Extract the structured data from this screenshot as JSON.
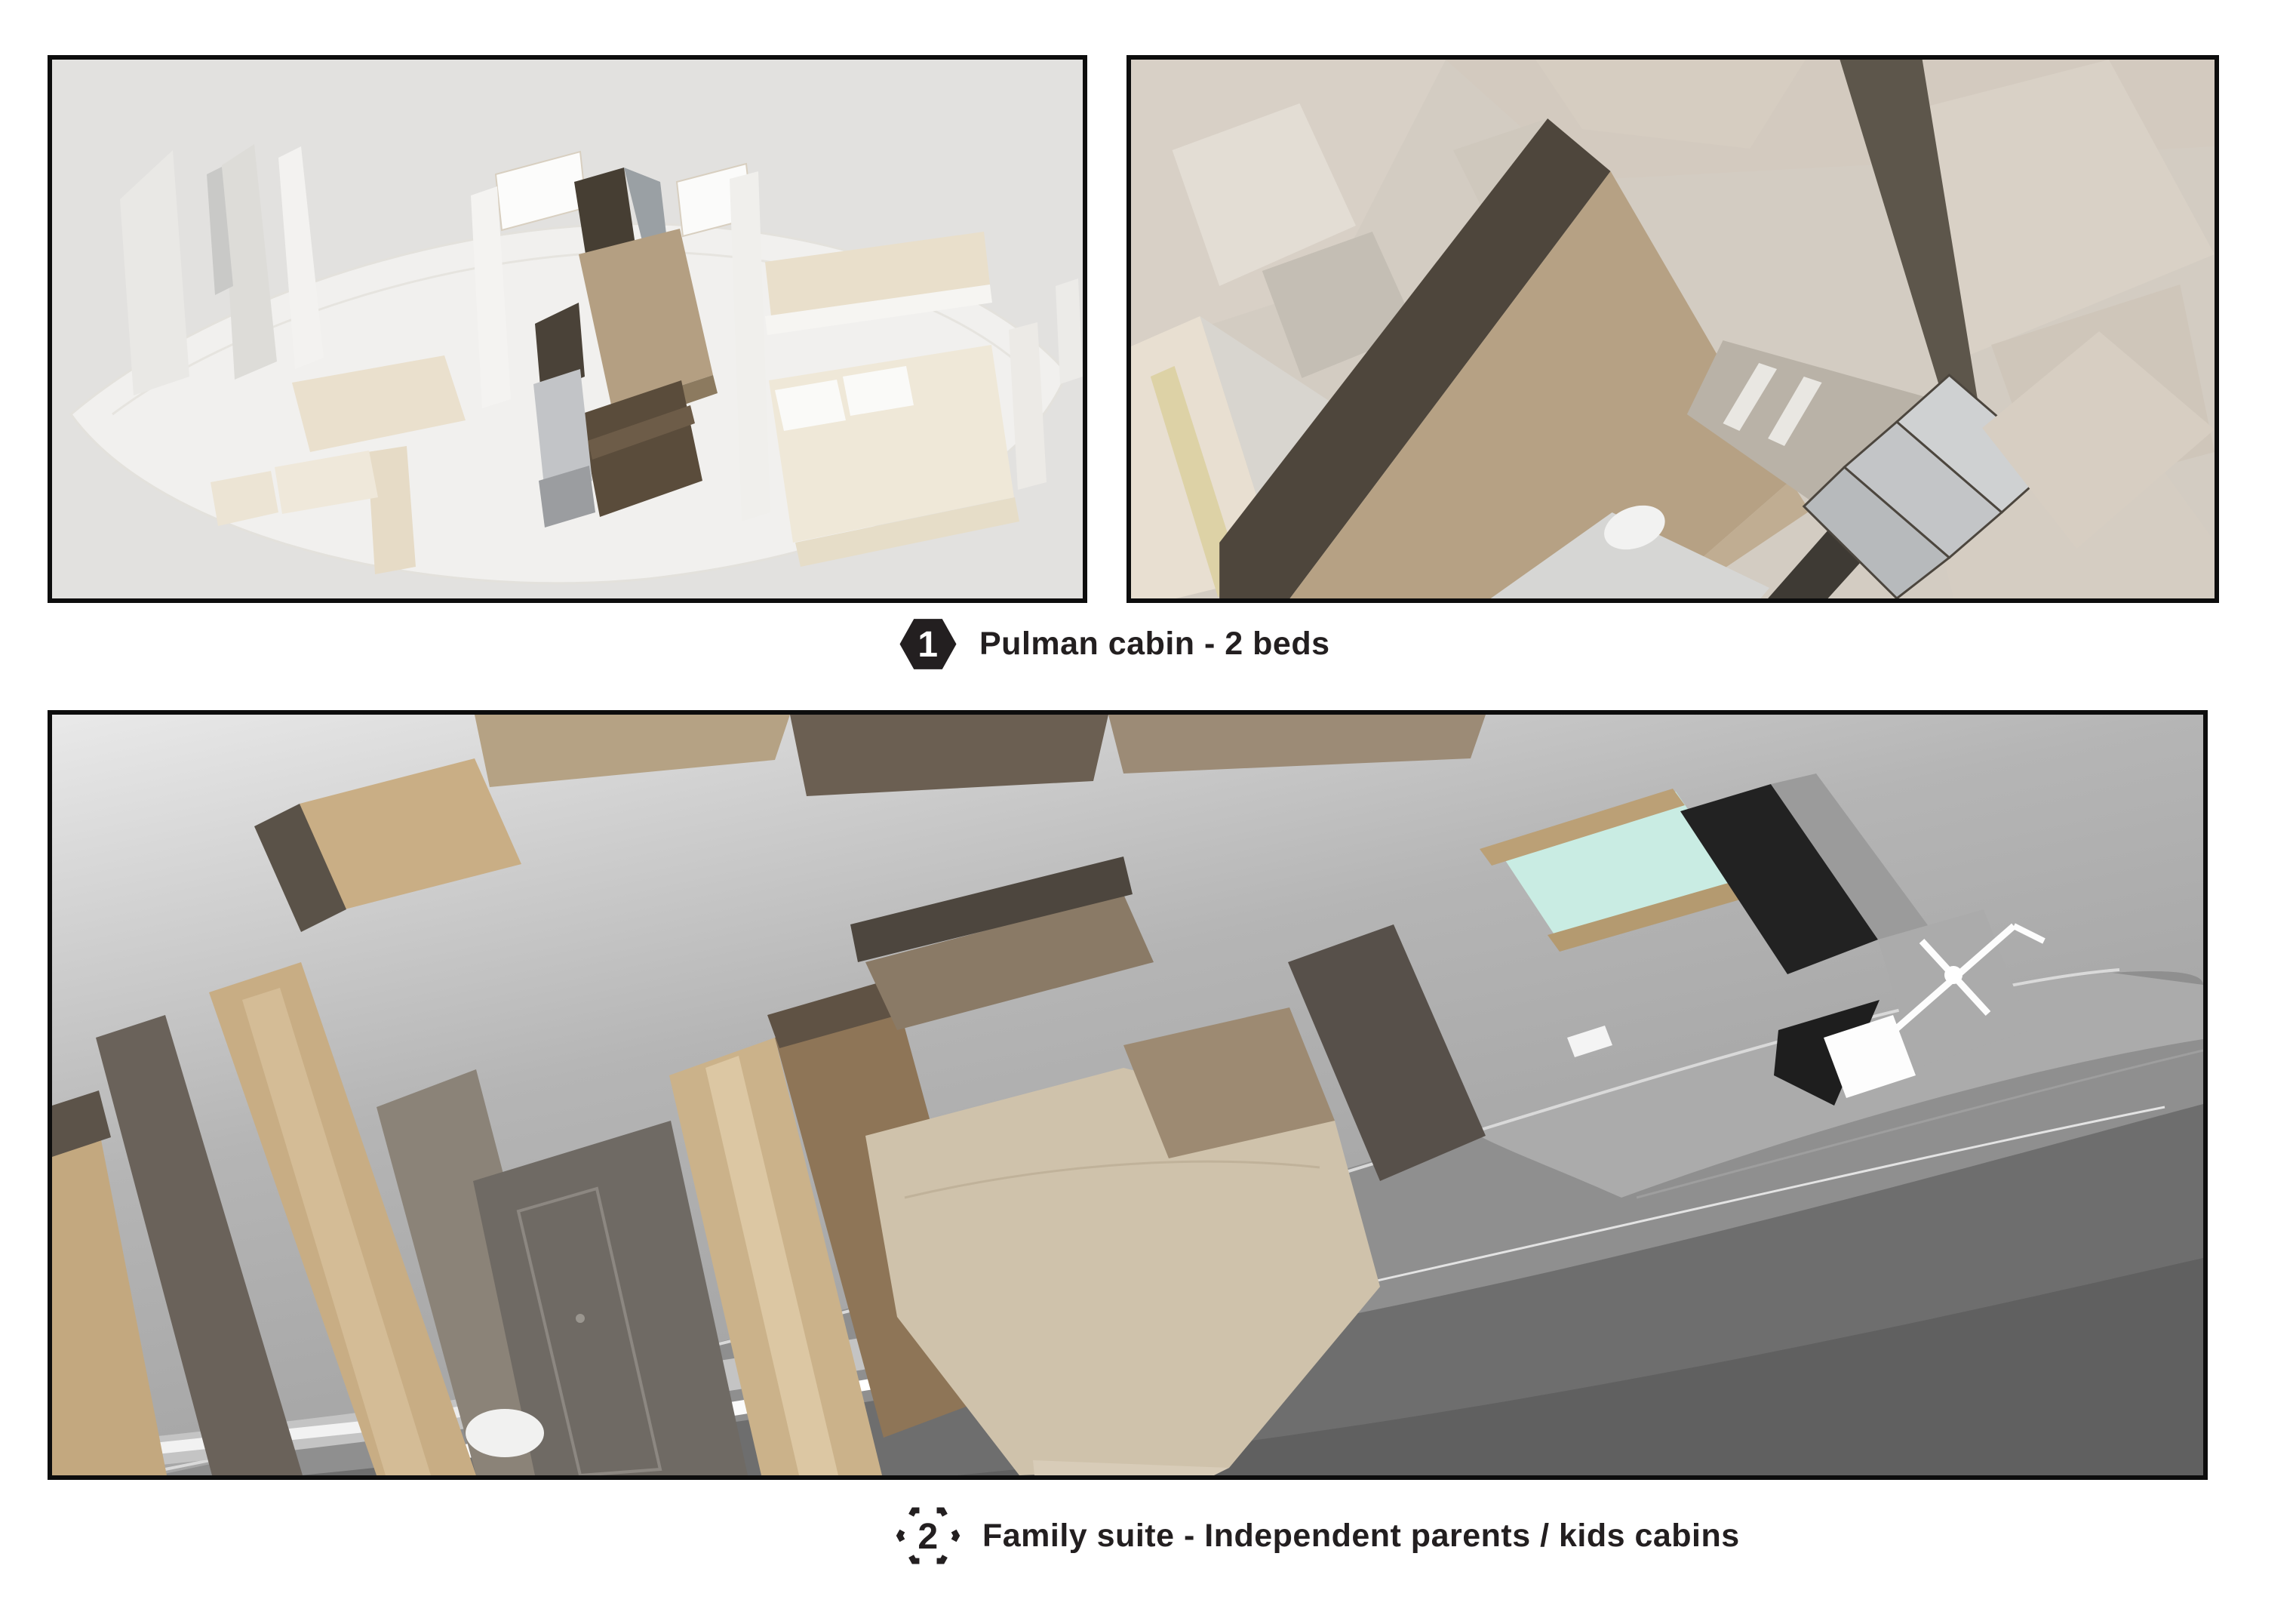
{
  "palette": {
    "ink": "#231f20",
    "page_bg": "#ffffff",
    "panel_border": "#0d0d0d",
    "panel1_bg": "#e2e1df",
    "ghost_white": "#f1f0ee",
    "ghost_beige": "#eae0cd",
    "cabin_dark_brown": "#463e33",
    "cabin_brown": "#5a4c3b",
    "cabin_tan": "#b49f82",
    "mattress_gray": "#c2c4c7",
    "panel2_bg": "#d3ccc2",
    "floor_tan": "#b6a184",
    "wall_dark": "#4e463c",
    "wall_darker": "#3e3a34",
    "suite_bed_beige": "#cfc2ab",
    "suite_wall_tan": "#c8ad84",
    "suite_wall_brown": "#8e7557",
    "suite_door_gray": "#6f6a64",
    "hull_gray": "#8f8f8f",
    "hull_dark": "#6e6e6e",
    "skylight_teal": "#c9ece3",
    "windshield_black": "#222222"
  },
  "captions": [
    {
      "number": "1",
      "badge_style": "solid-hexagon",
      "label": "Pulman cabin - 2 beds"
    },
    {
      "number": "2",
      "badge_style": "dashed-hexagon",
      "label": "Family suite - Independent parents / kids cabins"
    }
  ]
}
